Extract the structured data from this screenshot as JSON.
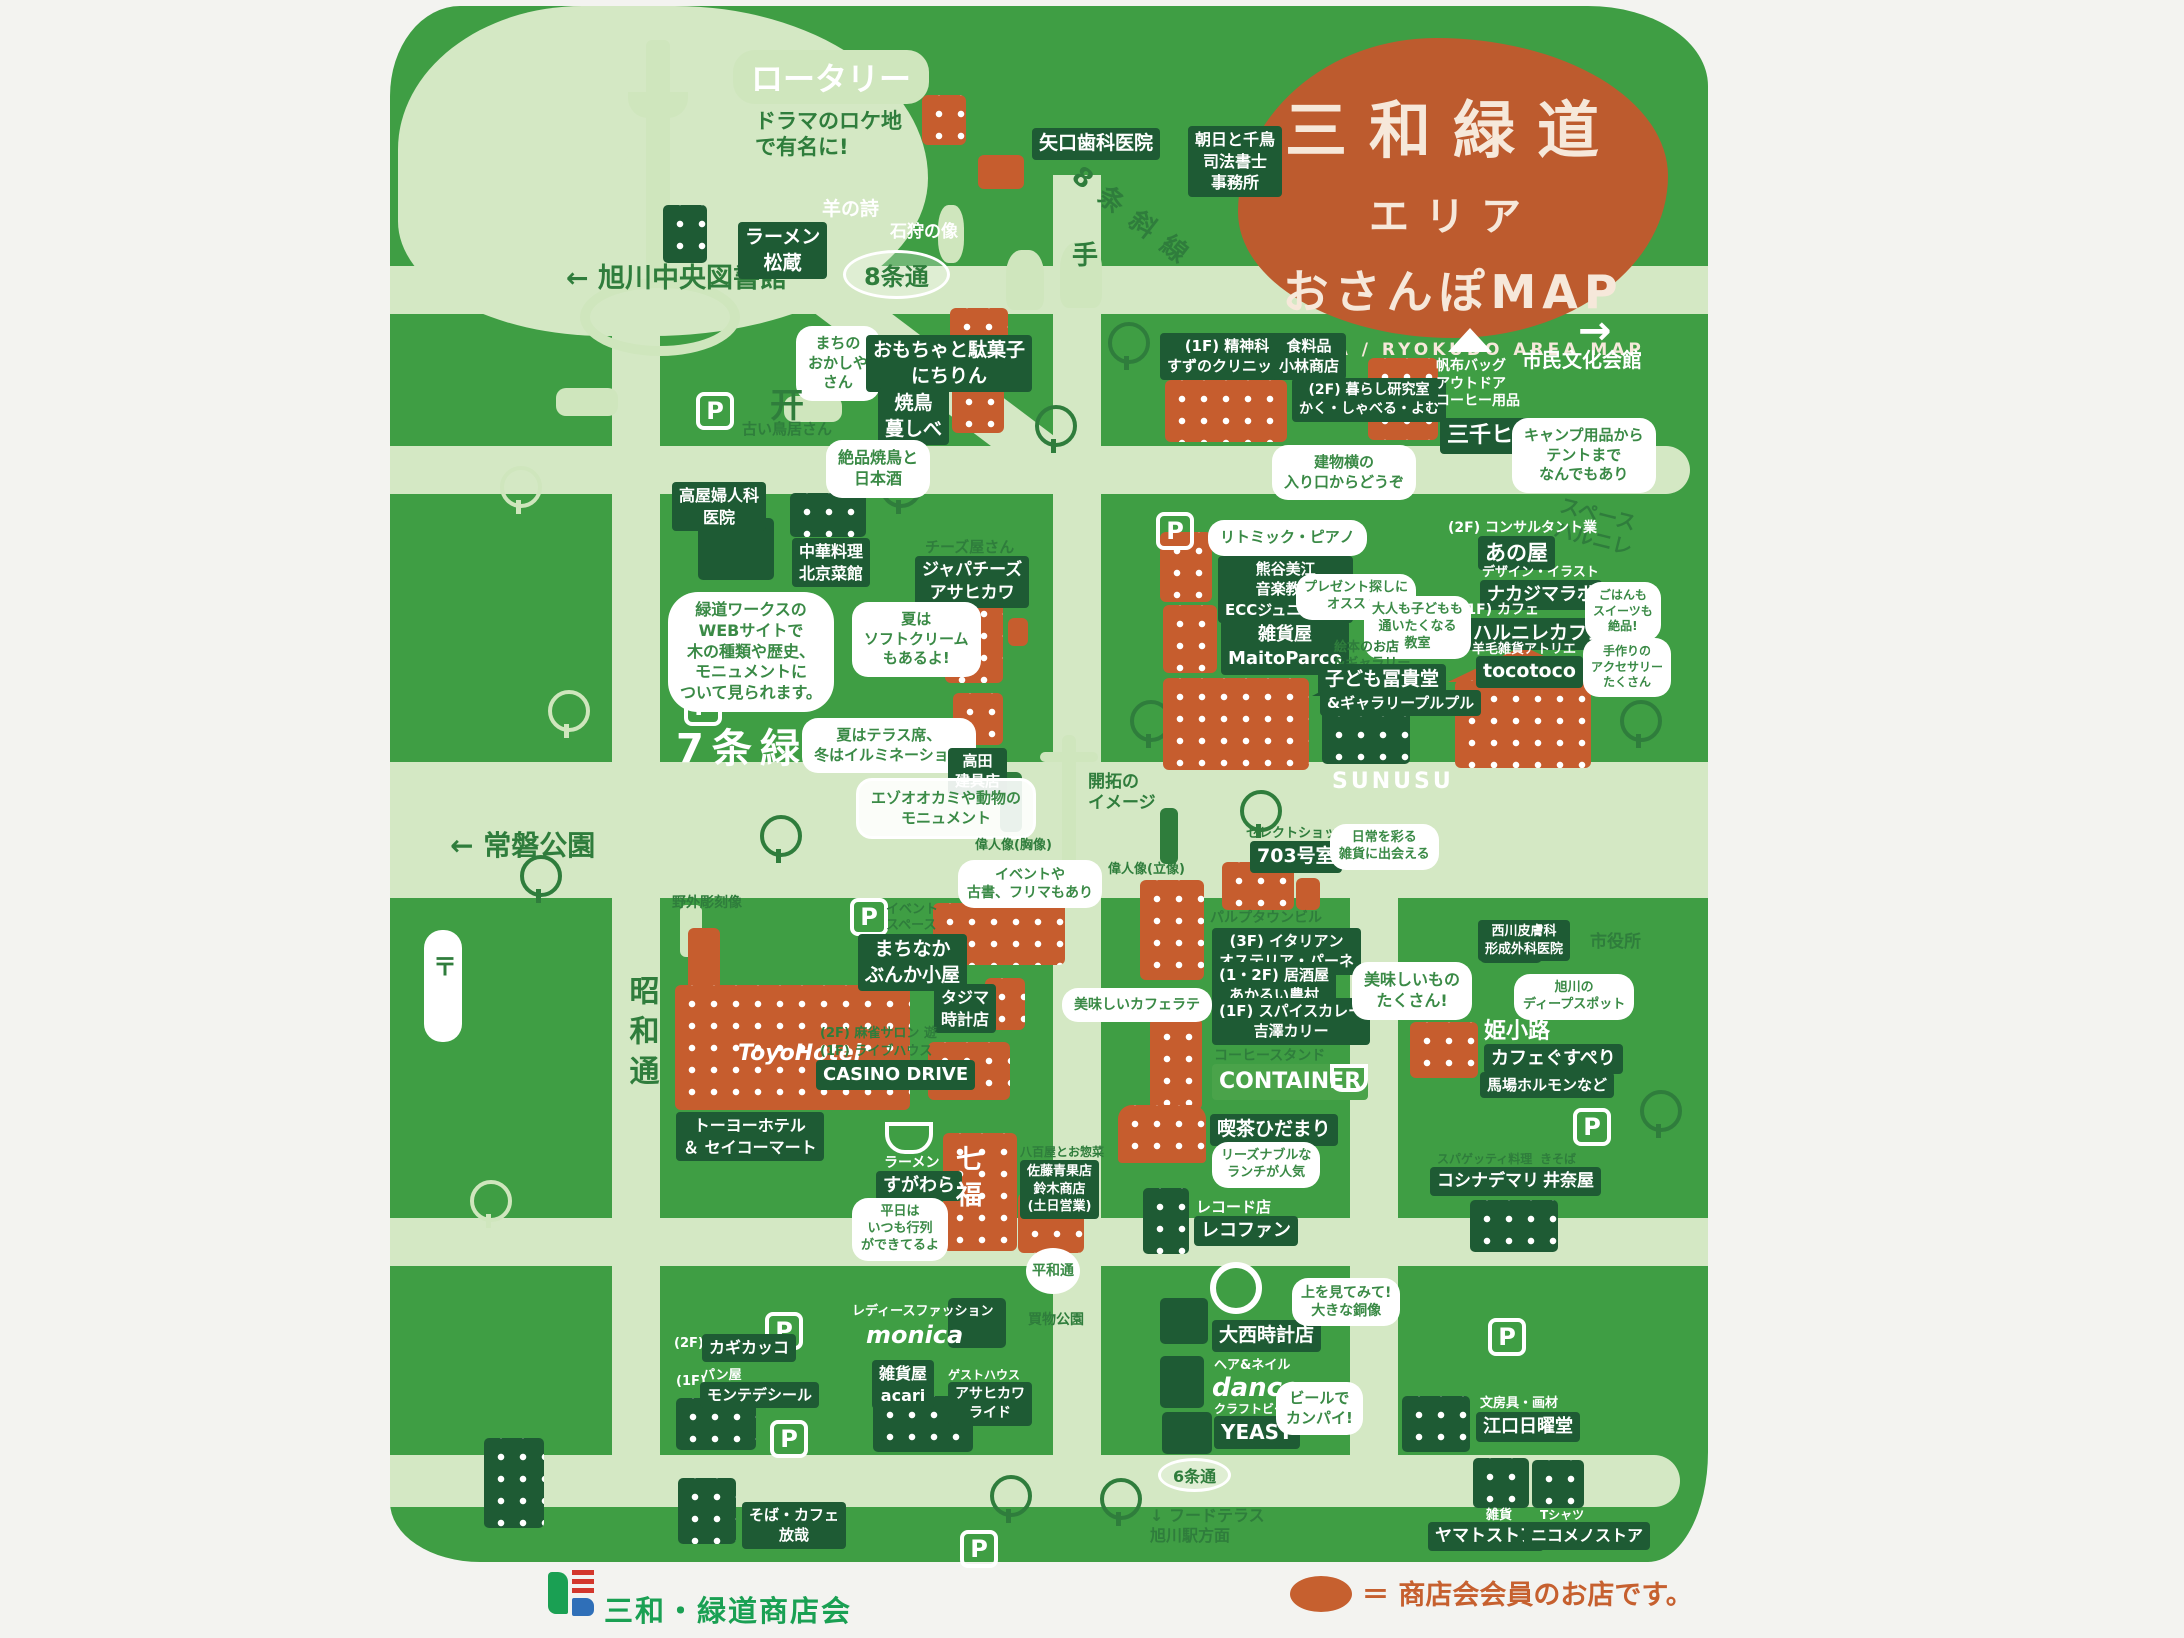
{
  "title": {
    "line1": "三和緑道",
    "line2": "エリア",
    "line3": "おさんぽMAP",
    "subtitle": "SANWA / RYOKUDO AREA MAP"
  },
  "legend": {
    "text": "＝ 商店会会員のお店です。",
    "swatch_color": "#c6602f"
  },
  "logo": {
    "text": "三和・緑道商店会"
  },
  "colors": {
    "map_green": "#3f9e44",
    "road_green": "#d4e8c4",
    "member_orange": "#c65d2e",
    "chip_dark": "#1e5b34"
  },
  "labels": {
    "rotary": "ロータリー",
    "rotary_note": "ドラマのロケ地\nで有名に!",
    "library": "← 旭川中央図書館",
    "jo8": "8条通",
    "diag_road": "8条斜線",
    "ramen_matsuzo": "ラーメン\n松蔵",
    "dental": "矢口歯科医院",
    "shiho": "朝日と千鳥\n司法書士\n事務所",
    "sheep": "羊の詩",
    "ishikari": "石狩の像",
    "te": "手",
    "culture_arrow": "→",
    "culture_hall": "市民文化会館",
    "okashiya_bubble": "まちの\nおかしや\nさん",
    "nichirin": "おもちゃと駄菓子\nにちりん",
    "torii": "开",
    "torii_note": "古い鳥居さん",
    "yakitori": "焼鳥\n蔓しべ",
    "yakitori_bubble": "絶品焼鳥と\n日本酒",
    "suzuno": "(1F) 精神科\nすずのクリニック",
    "kobayashi": "食料品\n小林商店",
    "kurashi": "(2F) 暮らし研究室\nかく・しゃべる・よむ",
    "michihito_genre": "帆布バッグ\nアウトドア\nコーヒー用品",
    "michihito": "三千ヒト",
    "camp_bubble": "キャンプ用品から\nテントまで\nなんでもあり",
    "entrance_bubble": "建物横の\n入り口からどうぞ",
    "fujinka": "高屋婦人科\n医院",
    "pekin": "中華料理\n北京菜館",
    "web_bubble": "緑道ワークスの\nWEBサイトで\n木の種類や歴史、\nモニュメントに\nついて見られます。",
    "cheese_genre": "チーズ屋さん",
    "cheese": "ジャパチーズ\nアサヒカワ",
    "soft_bubble": "夏は\nソフトクリーム\nもあるよ!",
    "ryokudo7": "7条緑道",
    "terrace_bubble": "夏はテラス席、\n冬はイルミネーション",
    "tategu": "高田\n建具店",
    "monument": "エゾオオカミや動物の\nモニュメント",
    "tokiwa": "← 常磐公園",
    "sculpture": "野外彫刻像",
    "kaitaku": "開拓の\nイメージ",
    "ijin1": "偉人像(胸像)",
    "ijin2": "偉人像(立像)",
    "space_harunire": "スペース\nハルニレ",
    "anoya_genre": "(2F) コンサルタント業",
    "anoya": "あの屋",
    "nakajima_genre": "デザイン・イラスト",
    "nakajima": "ナカジマラボ",
    "harunire_genre": "(1F) カフェ",
    "harunire": "ハルニレカフェ",
    "tocotoco_genre": "羊毛雑貨アトリエ",
    "tocotoco": "tocotoco",
    "gohan_bubble": "ごはんも\nスイーツも\n絶品!",
    "acc_bubble": "手作りの\nアクセサリー\nたくさん",
    "rhythm_bubble": "リトミック・ピアノ",
    "kumagai": "熊谷美江\n音楽教室\nECCジュニア教室",
    "maitoparco": "雑貨屋\nMaitoParco",
    "present_bubble": "プレゼント探しに\nオススメ!",
    "kyoshitsu_bubble": "大人も子どもも\n通いたくなる\n教室",
    "fukido_genre": "絵本のお店\n&ギャラリー",
    "fukido": "子ども冨貴堂",
    "purupuru": "&ギャラリープルプル",
    "sunusu": "SUNUSU",
    "room703_genre": "セレクトショップ",
    "room703": "703号室",
    "zakka_bubble": "日常を彩る\n雑貨に出会える",
    "pulp": "パルプタウンビル",
    "osteria": "(3F) イタリアン\nオステリア・パーネ",
    "noson": "(1・2F) 居酒屋\nあかるい農村",
    "curry": "(1F) スパイスカレー\n吉澤カリー",
    "container_genre": "コーヒースタンド",
    "container": "CONTAINER",
    "oishii_bubble": "美味しいもの\nたくさん!",
    "latte_bubble": "美味しいカフェラテ",
    "nishikawa": "西川皮膚科\n形成外科医院",
    "shiyakusho": "市役所",
    "deep_bubble": "旭川の\nディープスポット",
    "himekoji": "姫小路",
    "gusuperi": "カフェぐすぺり",
    "baba": "馬場ホルモンなど",
    "hidamari": "喫茶ひだまり",
    "lunch_bubble": "リーズナブルな\nランチが人気",
    "recofan_genre": "レコード店",
    "recofan": "レコファン",
    "yaoya_genre": "八百屋とお惣菜",
    "yaoya": "佐藤青果店\n鈴木商店\n(土日営業)",
    "sugawara_genre": "ラーメン",
    "sugawara": "すがわら",
    "shichifuku": "七福",
    "gyoretsu_bubble": "平日は\nいつも行列\nができてるよ",
    "kosinade_genre": "スパゲッティ料理",
    "kosinade": "コシナデマリア",
    "inaya_genre": "きそば",
    "inaya": "井奈屋",
    "showa": "昭和通",
    "toyo_sign": "ToyoHotel",
    "toyo": "トーヨーホテル\n＆ セイコーマート",
    "event_bubble": "イベントや\n古書、フリマもあり",
    "event_space": "イベント\nスペース",
    "bunka": "まちなか\nぶんか小屋",
    "tajima": "タジマ\n時計店",
    "mahjong": "(2F) 麻雀サロン 遊",
    "casino_genre": "(1F) ライブハウス",
    "casino": "CASINO DRIVE",
    "monica_genre": "レディースファッション",
    "monica": "monica",
    "kagikakko_floor": "(2F)",
    "kagikakko": "カギカッコ",
    "monte_floor": "(1F)",
    "monte_genre": "パン屋",
    "monte": "モンテデシール",
    "acari": "雑貨屋\nacari",
    "ride_genre": "ゲストハウス",
    "ride": "アサヒカワ\nライド",
    "hosai": "そば・カフェ\n放哉",
    "onishi": "大西時計店",
    "douzo_bubble": "上を見てみて!\n大きな銅像",
    "dance_genre": "ヘア&ネイル",
    "dance": "dance",
    "yeast_genre": "クラフトビール",
    "yeast": "YEAST",
    "beer_bubble": "ビールで\nカンパイ!",
    "eguchi_genre": "文房具・画材",
    "eguchi": "江口日曜堂",
    "jo6": "6条通",
    "heiwa1": "平和通",
    "heiwa2": "買物公園",
    "food_terrace": "↓ フードテラス\n旭川駅方面",
    "yamato_genre": "雑貨",
    "yamato": "ヤマトストア",
    "niko_genre": "Tシャツ",
    "niko": "ニコメノストア",
    "post": "〒",
    "p": "P"
  }
}
